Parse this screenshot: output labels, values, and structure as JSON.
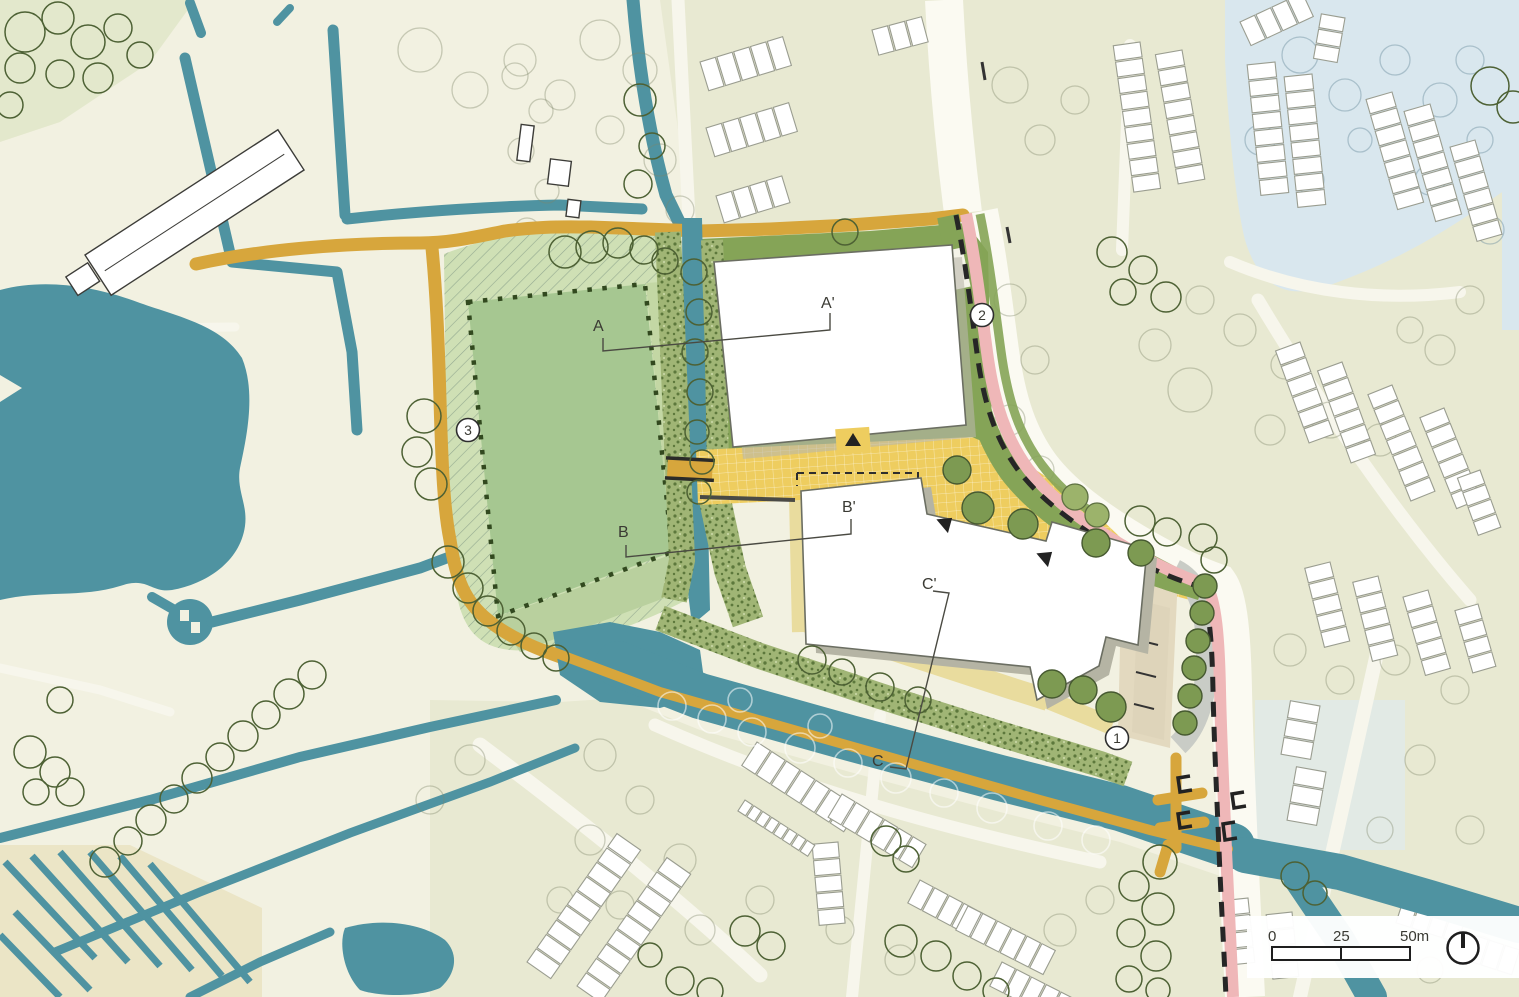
{
  "map": {
    "title": "Landscape masterplan site plan",
    "section_markers": {
      "a": {
        "start": "A",
        "end": "A'"
      },
      "b": {
        "start": "B",
        "end": "B'"
      },
      "c": {
        "start": "C",
        "end": "C'"
      }
    },
    "numbered_markers": {
      "m1": "1",
      "m2": "2",
      "m3": "3"
    },
    "scale_bar": {
      "t0": "0",
      "t25": "25",
      "t50": "50m"
    },
    "colors": {
      "background": "#f2f1e1",
      "water": "#4f93a1",
      "water_light": "#d9e7ee",
      "road_ochre": "#d7a63c",
      "plaza_yellow": "#eecd5f",
      "path_pink": "#efb7b8",
      "field_green": "#a6c791",
      "field_light": "#cfe0b5",
      "verge_green": "#85a457",
      "vegetation": "#a0b575",
      "tree_fill": "#7d9a52",
      "building": "#ffffff"
    }
  }
}
